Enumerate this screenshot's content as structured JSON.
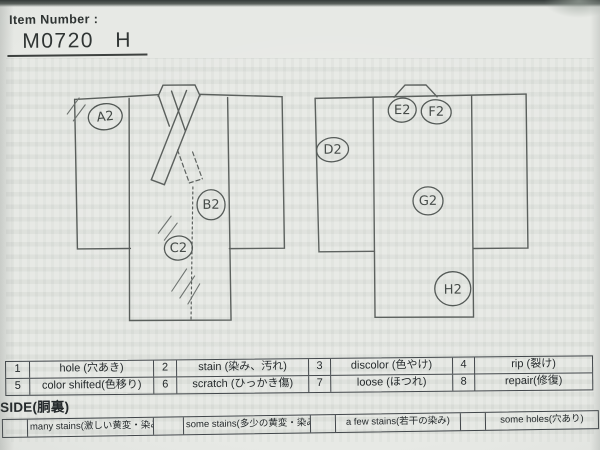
{
  "header": {
    "item_number_label": "Item Number :",
    "item_number_value": "M0720 H"
  },
  "diagrams": {
    "front": {
      "name": "kimono front view",
      "markers": [
        {
          "label": "A2"
        },
        {
          "label": "B2"
        },
        {
          "label": "C2"
        }
      ]
    },
    "back": {
      "name": "kimono back view",
      "markers": [
        {
          "label": "D2"
        },
        {
          "label": "E2"
        },
        {
          "label": "F2"
        },
        {
          "label": "G2"
        },
        {
          "label": "H2"
        }
      ]
    }
  },
  "legend": {
    "items": [
      {
        "num": "1",
        "label": "hole (穴あき)"
      },
      {
        "num": "2",
        "label": "stain (染み、汚れ)"
      },
      {
        "num": "3",
        "label": "discolor (色やけ)"
      },
      {
        "num": "4",
        "label": "rip (裂け)"
      },
      {
        "num": "5",
        "label": "color shifted(色移り)"
      },
      {
        "num": "6",
        "label": "scratch (ひっかき傷)"
      },
      {
        "num": "7",
        "label": "loose (ほつれ)"
      },
      {
        "num": "8",
        "label": "repair(修復)"
      }
    ]
  },
  "side_section": {
    "label": "SIDE(胴裏)"
  },
  "severity": {
    "items": [
      {
        "label": "many stains(激しい黄変・染み)"
      },
      {
        "label": "some stains(多少の黄変・染み)"
      },
      {
        "label": "a few stains(若干の染み)"
      },
      {
        "label": "some holes(穴あり)"
      }
    ]
  },
  "colors": {
    "paper": "#e7e9e5",
    "ink": "#23282a",
    "pencil": "#565b58"
  }
}
